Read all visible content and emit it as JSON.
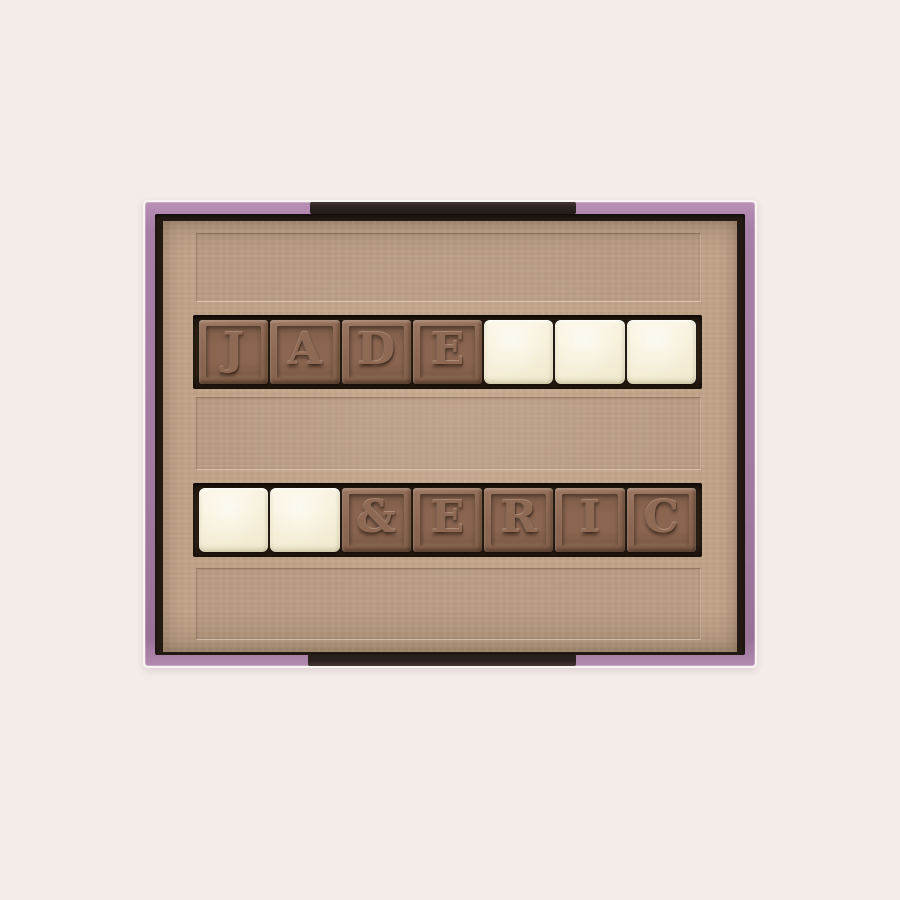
{
  "photo": {
    "subject": "open-chocolate-gift-box",
    "message_spelled": "JADE & ERIC",
    "background_color": "#f4ece8"
  },
  "box": {
    "rim_color": "#a47ba1",
    "rim_accent_color": "#2e2422",
    "interior_shadow_color": "#241a13",
    "tray_color": "#c2a589",
    "slot_color": "#2c2015"
  },
  "tiles": {
    "milk_chocolate_color": "#8d6853",
    "white_chocolate_color": "#f6f0da",
    "rows": [
      {
        "name": "row-1",
        "cells": [
          {
            "type": "milk",
            "letter": "J"
          },
          {
            "type": "milk",
            "letter": "A"
          },
          {
            "type": "milk",
            "letter": "D"
          },
          {
            "type": "milk",
            "letter": "E"
          },
          {
            "type": "white",
            "letter": ""
          },
          {
            "type": "white",
            "letter": ""
          },
          {
            "type": "white",
            "letter": ""
          }
        ]
      },
      {
        "name": "row-2",
        "cells": [
          {
            "type": "white",
            "letter": ""
          },
          {
            "type": "white",
            "letter": ""
          },
          {
            "type": "milk",
            "letter": "&"
          },
          {
            "type": "milk",
            "letter": "E"
          },
          {
            "type": "milk",
            "letter": "R"
          },
          {
            "type": "milk",
            "letter": "I"
          },
          {
            "type": "milk",
            "letter": "C"
          }
        ]
      }
    ]
  }
}
